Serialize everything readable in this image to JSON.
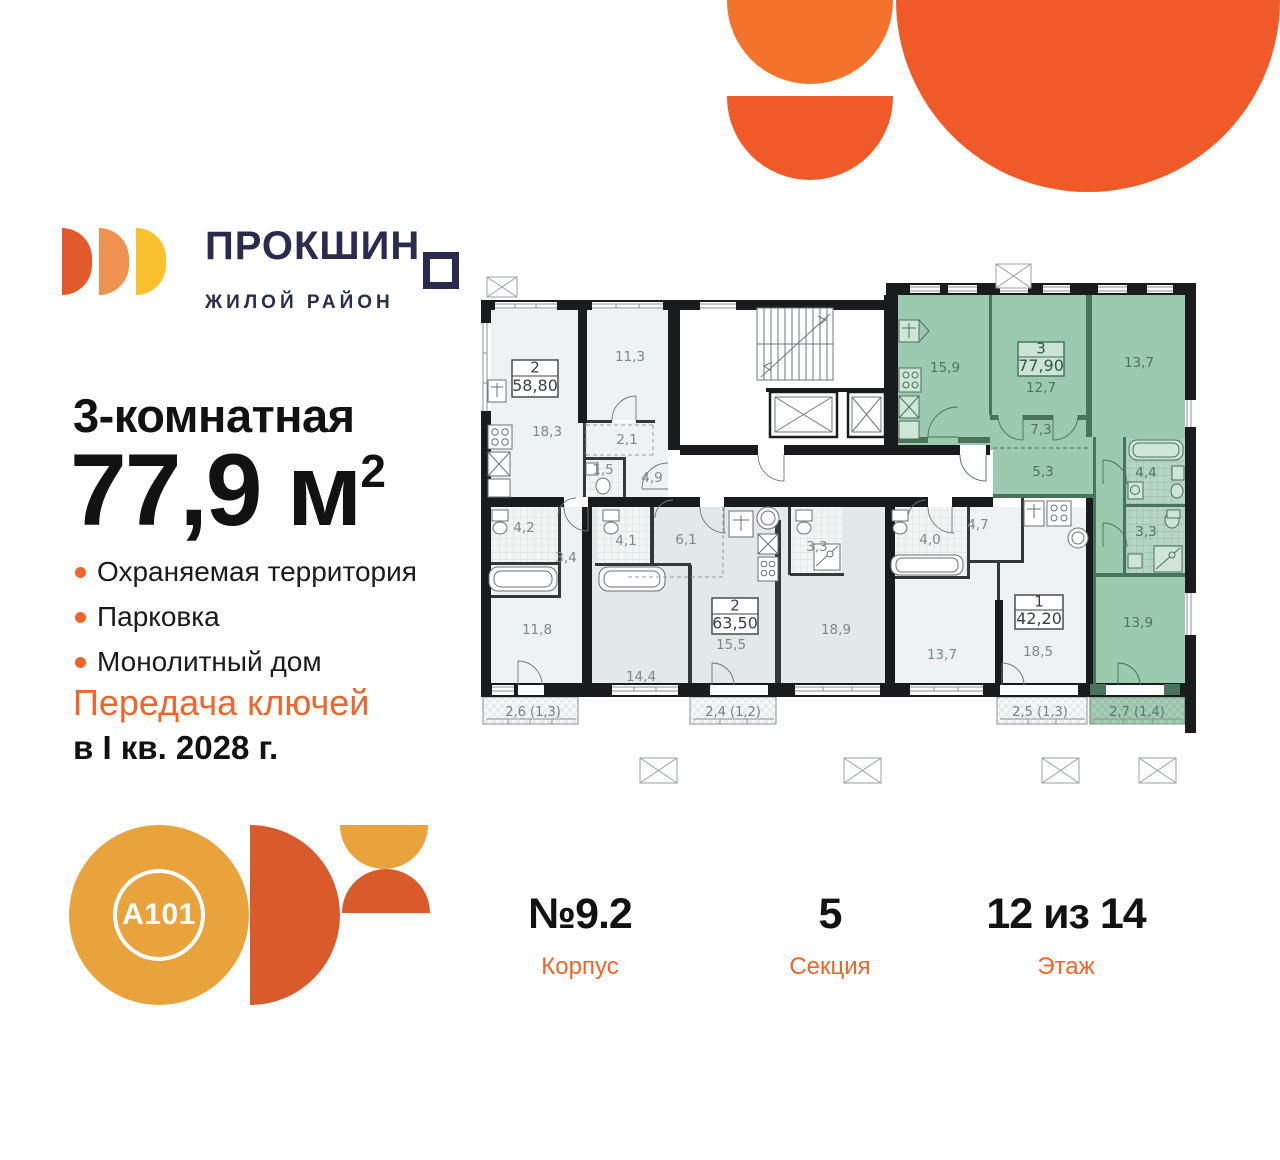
{
  "brand": {
    "name_prefix": "ПРОКШИН",
    "name_last": "О",
    "subtitle": "ЖИЛОЙ РАЙОН"
  },
  "offer": {
    "title": "3-комнатная",
    "area_value": "77,9",
    "area_unit": "м",
    "area_sup": "2",
    "features": [
      "Охраняемая территория",
      "Парковка",
      "Монолитный дом"
    ],
    "handover_line1": "Передача ключей",
    "handover_line2": "в I кв. 2028 г."
  },
  "developer": {
    "logo_text": "A101"
  },
  "stats": [
    {
      "value": "№9.2",
      "label": "Корпус"
    },
    {
      "value": "5",
      "label": "Секция"
    },
    {
      "value": "12 из 14",
      "label": "Этаж"
    }
  ],
  "colors": {
    "accent_orange": "#f26428",
    "brand_navy": "#2b2b4e",
    "highlight_green": "#9ccaae",
    "deco_orange": "#f05a28",
    "logo_gold": "#e8a33d"
  },
  "floorplan": {
    "apartments": [
      {
        "rooms": "2",
        "area": "58,80",
        "highlighted": false
      },
      {
        "rooms": "2",
        "area": "63,50",
        "highlighted": false
      },
      {
        "rooms": "1",
        "area": "42,20",
        "highlighted": false
      },
      {
        "rooms": "3",
        "area": "77,90",
        "highlighted": true
      }
    ],
    "room_labels": [
      "18,3",
      "11,3",
      "2,1",
      "1,5",
      "4,9",
      "4,2",
      "3,4",
      "11,8",
      "4,1",
      "6,1",
      "3,3",
      "14,4",
      "15,5",
      "18,9",
      "4,7",
      "4,0",
      "13,7",
      "18,5",
      "15,9",
      "12,7",
      "13,7",
      "7,3",
      "5,3",
      "4,4",
      "3,3",
      "13,9"
    ],
    "balcony_labels": [
      "2,6 (1,3)",
      "2,4 (1,2)",
      "2,5 (1,3)",
      "2,7 (1,4)"
    ]
  }
}
